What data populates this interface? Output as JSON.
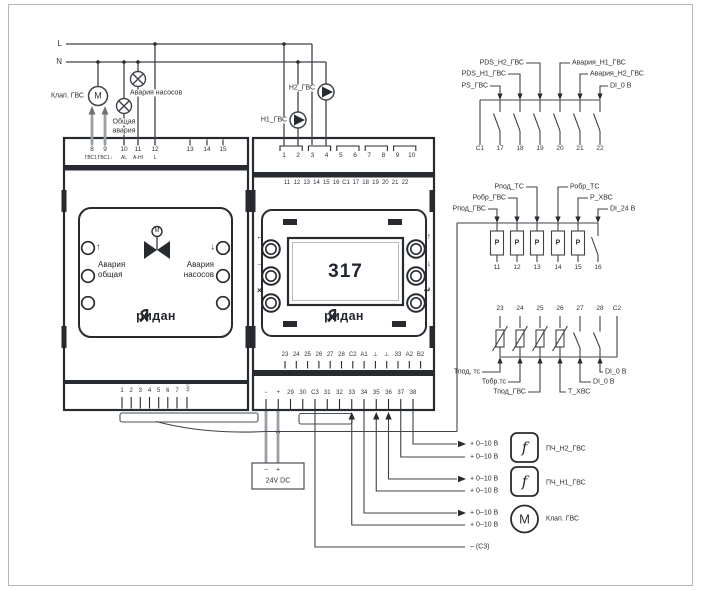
{
  "supply_lines": {
    "line1": "L",
    "line2": "N"
  },
  "actuators": {
    "valve_label": "Клап. ГВС",
    "valve_symbol": "M",
    "lamp_common_1": "Общая",
    "lamp_common_2": "авария",
    "lamp_pumps": "Авария насосов",
    "pump_h1": "H1_ГВС",
    "pump_h2": "H2_ГВС"
  },
  "left_module": {
    "top_terminals": [
      "8",
      "9",
      "10",
      "11",
      "12"
    ],
    "top_terminal_labels": [
      "ГВС1↑",
      "ГВС1↓",
      "AL",
      "A-HI",
      "L"
    ],
    "top_terminals_b": [
      "13",
      "14",
      "15"
    ],
    "face": {
      "arrow_up": "↑",
      "arrow_down": "↓",
      "motor": "M",
      "alarm_left_1": "Авария",
      "alarm_left_2": "общая",
      "alarm_right_1": "Авария",
      "alarm_right_2": "насосов",
      "brand": "ридан"
    },
    "bottom_terminals": [
      "1",
      "2",
      "3",
      "4",
      "5",
      "6",
      "7"
    ],
    "bottom_side_label": "CAN"
  },
  "right_module": {
    "row1": [
      "1",
      "2",
      "3",
      "4",
      "5",
      "6",
      "7",
      "8",
      "9",
      "10"
    ],
    "row2": [
      "11",
      "12",
      "13",
      "14",
      "15",
      "16",
      "C1",
      "17",
      "18",
      "19",
      "20",
      "21",
      "22"
    ],
    "rowA": [
      "23",
      "24",
      "25",
      "26",
      "27",
      "28",
      "C2",
      "A1",
      "⊥",
      "⊥",
      "33",
      "A2",
      "B2"
    ],
    "rowB": [
      "−",
      "+",
      "29",
      "30",
      "C3",
      "31",
      "32",
      "33",
      "34",
      "35",
      "36",
      "37",
      "38"
    ],
    "face": {
      "display_value": "317",
      "brand": "ридан",
      "btn_back": "←",
      "btn_right": "→",
      "btn_close": "×",
      "btn_up": "↑",
      "btn_down": "↓",
      "btn_enter": "↵"
    }
  },
  "digital_inputs": {
    "terminals": [
      "C1",
      "17",
      "18",
      "19",
      "20",
      "21",
      "22"
    ],
    "labels": [
      "PS_ГВС",
      "PDS_H1_ГВС",
      "PDS_H2_ГВС",
      "Авария_H1_ГВС",
      "Авария_H2_ГВС",
      "DI_0 В"
    ]
  },
  "pressure_inputs": {
    "terminals": [
      "11",
      "12",
      "13",
      "14",
      "15",
      "16"
    ],
    "labels": [
      "Рпод_ГВС",
      "Робр_ГВС",
      "Рпод_ТС",
      "Робр_ТС",
      "P_ХВС",
      "DI_24 В"
    ],
    "sensor_symbol": "P"
  },
  "temp_inputs": {
    "terminals": [
      "23",
      "24",
      "25",
      "26",
      "27",
      "28",
      "C2"
    ],
    "labels": [
      "Тпод, тс",
      "Тобр.тс",
      "Тпод_ГВС",
      "Т_ХВС",
      "DI_0 В",
      "DI_0 В"
    ]
  },
  "power_supply": {
    "minus": "−",
    "plus": "+",
    "label": "24V DC"
  },
  "outputs": {
    "signal_label": "+ 0–10 В",
    "devices": [
      {
        "symbol": "f",
        "label": "ПЧ_Н2_ГВС"
      },
      {
        "symbol": "f",
        "label": "ПЧ_Н1_ГВС"
      },
      {
        "symbol": "M",
        "label": "Клап. ГВС"
      }
    ],
    "common_label": "– (С3)"
  },
  "colors": {
    "wire": "#3f444a",
    "power_wire": "#9aa0a6",
    "dark": "#272b30",
    "display_text": "#20262e"
  }
}
